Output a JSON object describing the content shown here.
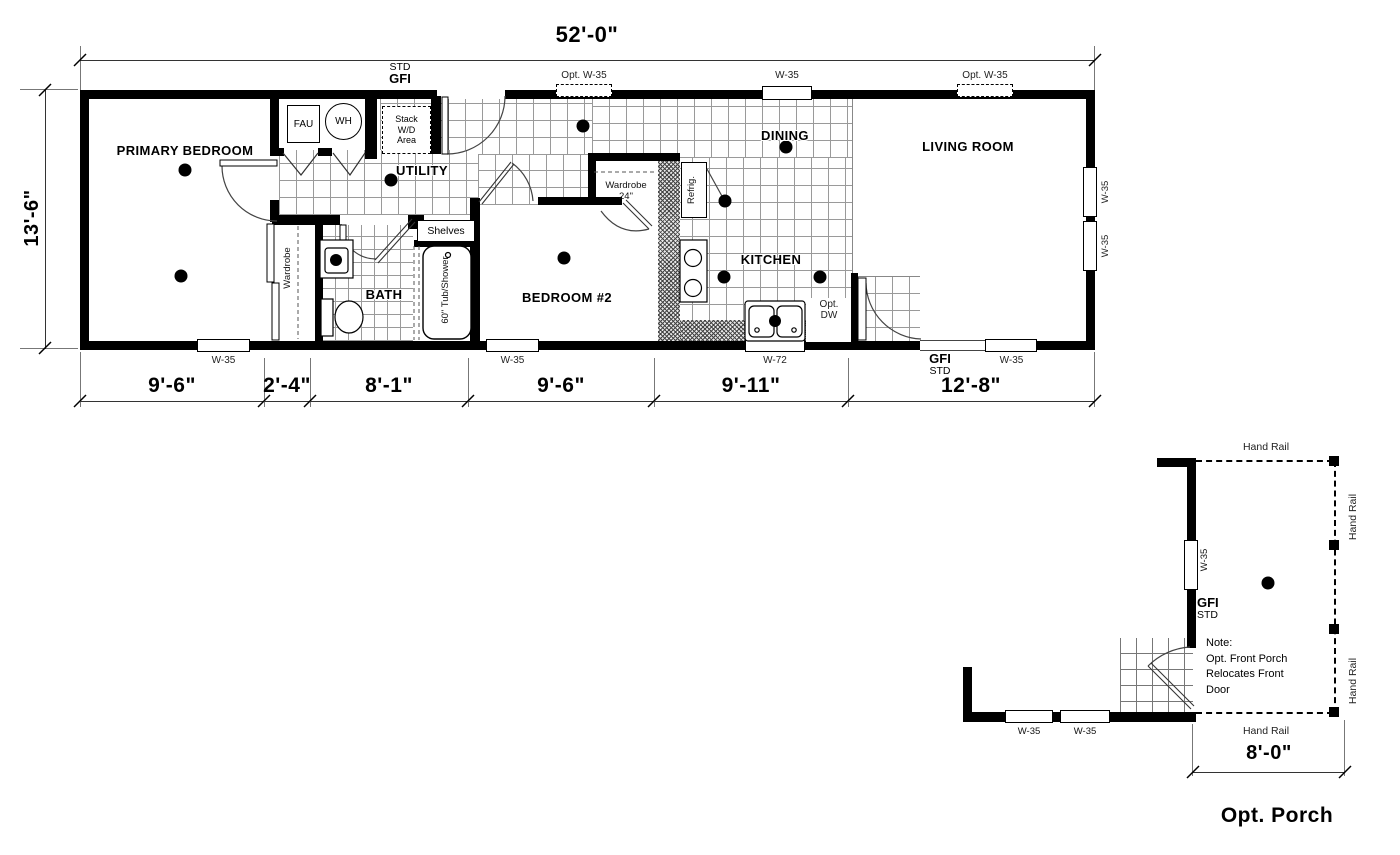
{
  "colors": {
    "ink": "#000000",
    "background": "#ffffff"
  },
  "plan": {
    "dim_width": "52'-0\"",
    "dim_height": "13'-6\"",
    "dims_bottom": [
      "9'-6\"",
      "2'-4\"",
      "8'-1\"",
      "9'-6\"",
      "9'-11\"",
      "12'-8\""
    ],
    "rooms": {
      "primary": "PRIMARY BEDROOM",
      "utility": "UTILITY",
      "bath": "BATH",
      "bedroom2": "BEDROOM #2",
      "kitchen": "KITCHEN",
      "dining": "DINING",
      "living": "LIVING ROOM"
    },
    "labels": {
      "fau": "FAU",
      "wh": "WH",
      "stack_wd": "Stack\nW/D\nArea",
      "shelves": "Shelves",
      "wardrobe": "Wardrobe",
      "wardrobe_width": "24\"",
      "tub": "60\" Tub/Shower",
      "refrig": "Refrig.",
      "opt_dw": "Opt.\nDW",
      "gfi": "GFI",
      "std": "STD",
      "w35": "W-35",
      "opt_w35": "Opt. W-35",
      "w72": "W-72"
    }
  },
  "porch": {
    "title": "Opt. Porch",
    "dim": "8'-0\"",
    "hand_rail": "Hand Rail",
    "w35": "W-35",
    "gfi": "GFI",
    "std": "STD",
    "note": "Note:\nOpt. Front Porch\nRelocates Front\nDoor"
  }
}
